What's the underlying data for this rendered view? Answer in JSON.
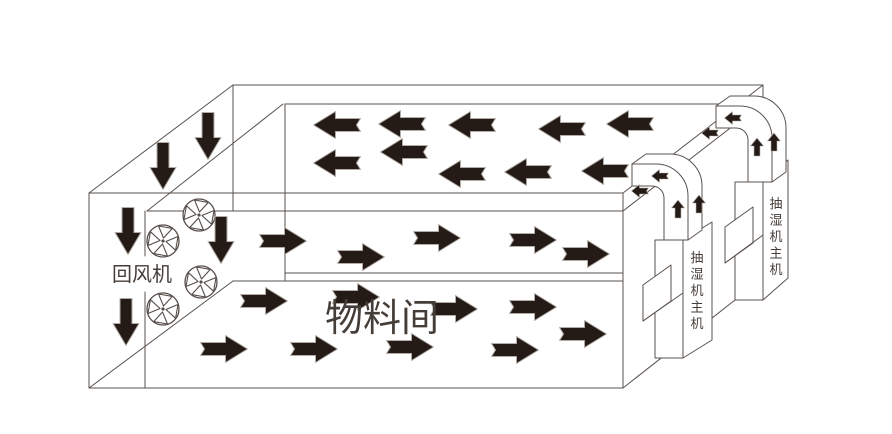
{
  "title": "drying-room-airflow-diagram",
  "colors": {
    "background": "#ffffff",
    "line": "#5a524e",
    "arrow_fill": "#241b16",
    "arrow_outline": "#b3aca6",
    "text": "#453d38"
  },
  "labels": [
    {
      "id": "return-fan-label",
      "text": "回风机",
      "x": 142,
      "y": 281,
      "size": 20,
      "orientation": "horizontal"
    },
    {
      "id": "material-room-label",
      "text": "物料间",
      "x": 382,
      "y": 331,
      "size": 38,
      "orientation": "horizontal"
    },
    {
      "id": "dehumidifier-near-label",
      "text": "抽湿机主机",
      "x": 697,
      "y": 262,
      "size": 13,
      "orientation": "vertical"
    },
    {
      "id": "dehumidifier-far-label",
      "text": "抽湿机主机",
      "x": 776,
      "y": 208,
      "size": 13,
      "orientation": "vertical"
    }
  ],
  "fans": {
    "r": 16,
    "centers": [
      [
        199,
        215
      ],
      [
        163,
        241
      ],
      [
        201,
        282
      ],
      [
        163,
        309
      ]
    ]
  },
  "arrows": {
    "left_large": [
      [
        337,
        125
      ],
      [
        402,
        124
      ],
      [
        472,
        125
      ],
      [
        562,
        129
      ],
      [
        630,
        124
      ],
      [
        337,
        163
      ],
      [
        404,
        152
      ],
      [
        462,
        174
      ],
      [
        528,
        172
      ],
      [
        605,
        171
      ]
    ],
    "right_large": [
      [
        283,
        241
      ],
      [
        437,
        238
      ],
      [
        533,
        240
      ],
      [
        361,
        257
      ],
      [
        586,
        254
      ],
      [
        264,
        301
      ],
      [
        356,
        297
      ],
      [
        454,
        309
      ],
      [
        533,
        307
      ],
      [
        583,
        334
      ],
      [
        224,
        349
      ],
      [
        314,
        349
      ],
      [
        410,
        347
      ],
      [
        515,
        350
      ]
    ],
    "down_large": [
      [
        163,
        166
      ],
      [
        208,
        136
      ],
      [
        128,
        231
      ],
      [
        126,
        322
      ],
      [
        221,
        240
      ]
    ],
    "up_small": [
      [
        757,
        147
      ],
      [
        774,
        142
      ],
      [
        678,
        209
      ],
      [
        699,
        204
      ]
    ],
    "left_small": [
      [
        733,
        118
      ],
      [
        710,
        133
      ],
      [
        660,
        176
      ],
      [
        640,
        191
      ]
    ]
  }
}
